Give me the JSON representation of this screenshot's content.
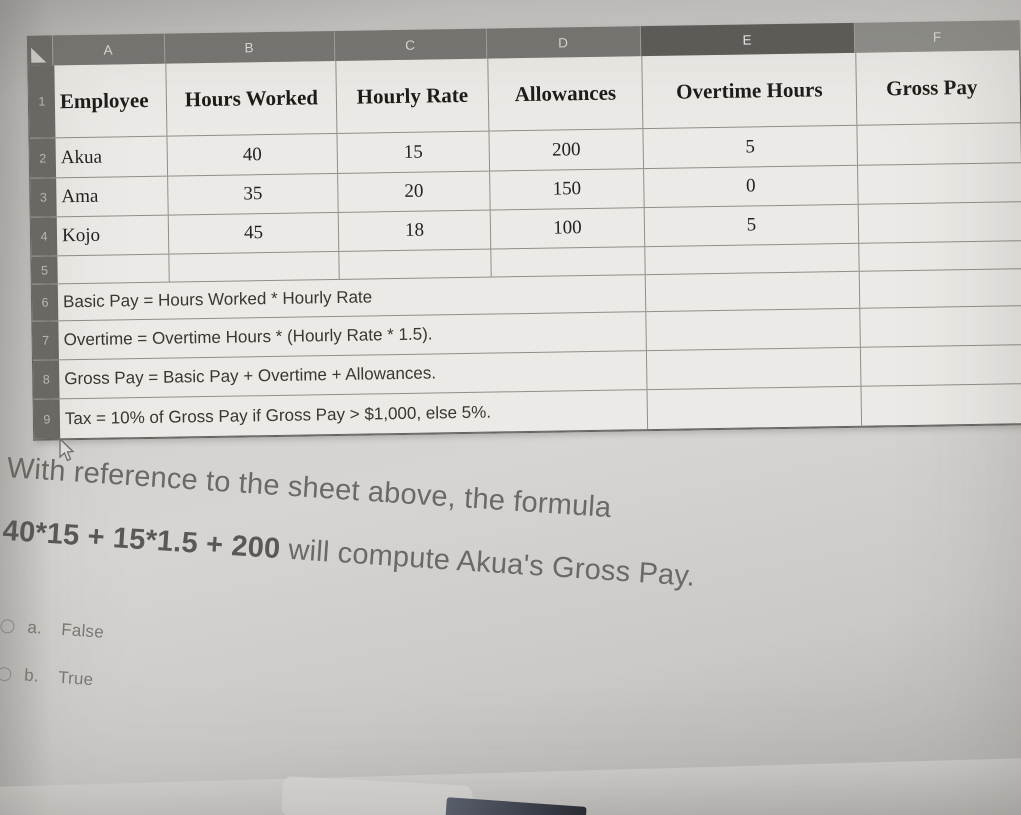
{
  "sheet": {
    "column_letters": [
      "A",
      "B",
      "C",
      "D",
      "E",
      "F"
    ],
    "row_numbers": [
      "1",
      "2",
      "3",
      "4",
      "5",
      "6",
      "7",
      "8",
      "9"
    ],
    "header_cells": [
      "Employee",
      "Hours Worked",
      "Hourly Rate",
      "Allowances",
      "Overtime Hours",
      "Gross Pay"
    ],
    "data_rows": [
      {
        "employee": "Akua",
        "hours_worked": "40",
        "hourly_rate": "15",
        "allowances": "200",
        "overtime_hours": "5",
        "gross_pay": ""
      },
      {
        "employee": "Ama",
        "hours_worked": "35",
        "hourly_rate": "20",
        "allowances": "150",
        "overtime_hours": "0",
        "gross_pay": ""
      },
      {
        "employee": "Kojo",
        "hours_worked": "45",
        "hourly_rate": "18",
        "allowances": "100",
        "overtime_hours": "5",
        "gross_pay": ""
      }
    ],
    "note_rows": [
      "Basic Pay = Hours Worked * Hourly Rate",
      "Overtime = Overtime Hours * (Hourly Rate * 1.5).",
      "Gross Pay = Basic Pay + Overtime + Allowances.",
      "Tax = 10% of Gross Pay if Gross Pay > $1,000, else 5%."
    ]
  },
  "question": {
    "line1": "With reference to the sheet above, the formula",
    "formula": "40*15 + 15*1.5 + 200",
    "line2_rest": " will compute Akua's Gross Pay."
  },
  "options": [
    {
      "letter": "a.",
      "label": "False"
    },
    {
      "letter": "b.",
      "label": "True"
    }
  ],
  "colors": {
    "column_header_strip": "#787672",
    "selected_column_header": "#5d5c58",
    "row_header_column": "#6c6a66",
    "cell_background": "#eceae6",
    "grid_line": "#8f8e89",
    "question_text": "#6b6965"
  }
}
